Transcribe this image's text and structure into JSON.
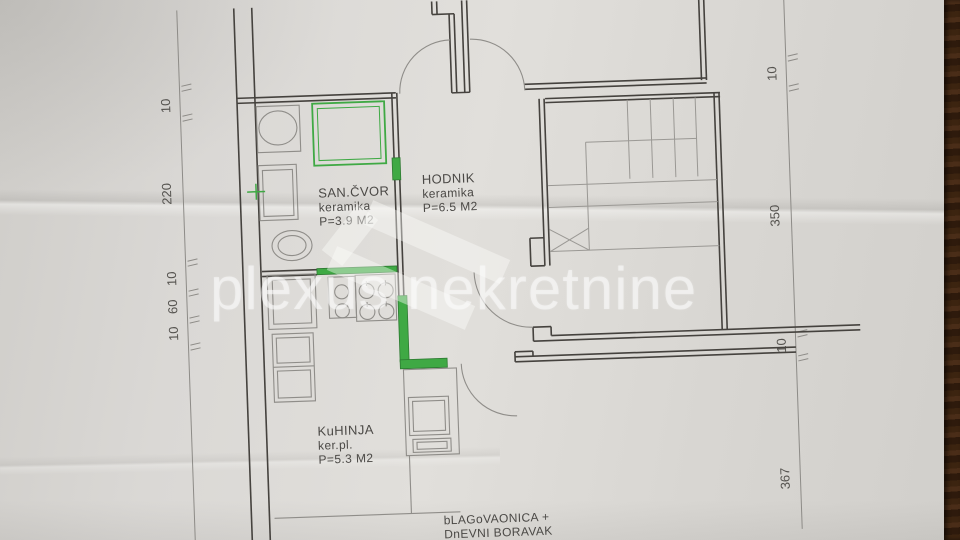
{
  "watermark": {
    "text": "plexus nekretnine"
  },
  "rooms": {
    "san_cvor": {
      "name": "SAN.ČVOR",
      "finish": "keramika",
      "area": "P=3.9 M2"
    },
    "hodnik": {
      "name": "HODNIK",
      "finish": "keramika",
      "area": "P=6.5 M2"
    },
    "kuhinja": {
      "name": "KuHINJA",
      "finish": "ker.pl.",
      "area": "P=5.3 M2"
    },
    "blagovaonica": {
      "line1": "bLAGoVAONICA +",
      "line2": "DnEVNI BORAVAK"
    }
  },
  "dimensions": {
    "left": [
      "10",
      "220",
      "10",
      "60",
      "10"
    ],
    "right": [
      "10",
      "350",
      "10",
      "367"
    ]
  },
  "colors": {
    "highlight_green": "#3fa944",
    "wood_brown": "#3a2214",
    "paper": "#d9d7d4",
    "wall": "#45423e",
    "thin_line": "#8f8d89",
    "text_ink": "#4b4946"
  }
}
